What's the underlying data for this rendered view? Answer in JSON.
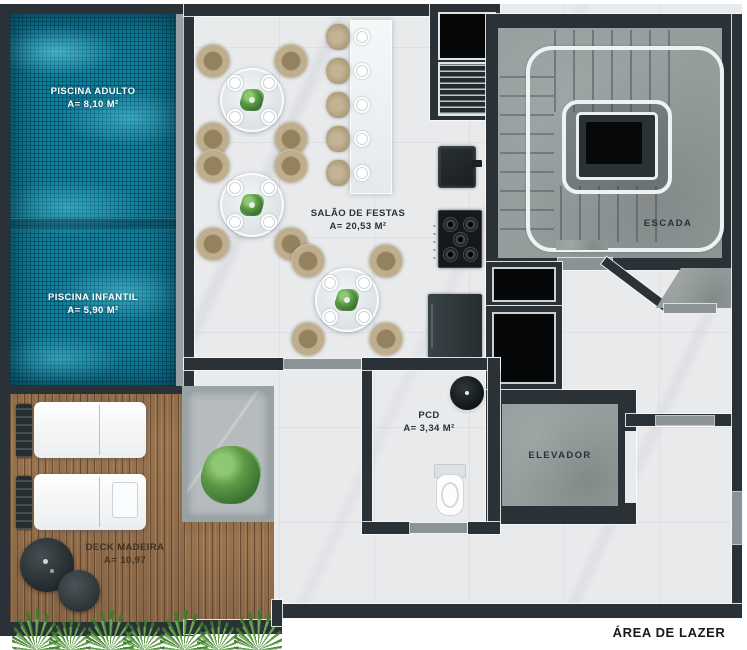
{
  "title": "ÁREA DE LAZER",
  "rooms": {
    "piscina_adulto": {
      "name": "PISCINA ADULTO",
      "area": "A= 8,10 M²"
    },
    "piscina_infantil": {
      "name": "PISCINA INFANTIL",
      "area": "A= 5,90 M²"
    },
    "salao_festas": {
      "name": "SALÃO DE FESTAS",
      "area": "A= 20,53 M²"
    },
    "pcd": {
      "name": "PCD",
      "area": "A= 3,34 M²"
    },
    "deck_madeira": {
      "name": "DECK MADEIRA",
      "area": "A= 10,97"
    },
    "escada": {
      "name": "ESCADA"
    },
    "elevador": {
      "name": "ELEVADOR"
    }
  },
  "colors": {
    "wall": "#2a3237",
    "pool_water": "#0f7e9b",
    "marble_floor": "#e9eaec",
    "concrete_floor": "#949b9b",
    "deck_wood": "#9a7450",
    "chair_upholstery": "#b5a384",
    "plant_green": "#4f8a3e",
    "shaft_black": "#060708",
    "pool_label_text": "#ffffff",
    "room_label_text": "#2c3135"
  }
}
